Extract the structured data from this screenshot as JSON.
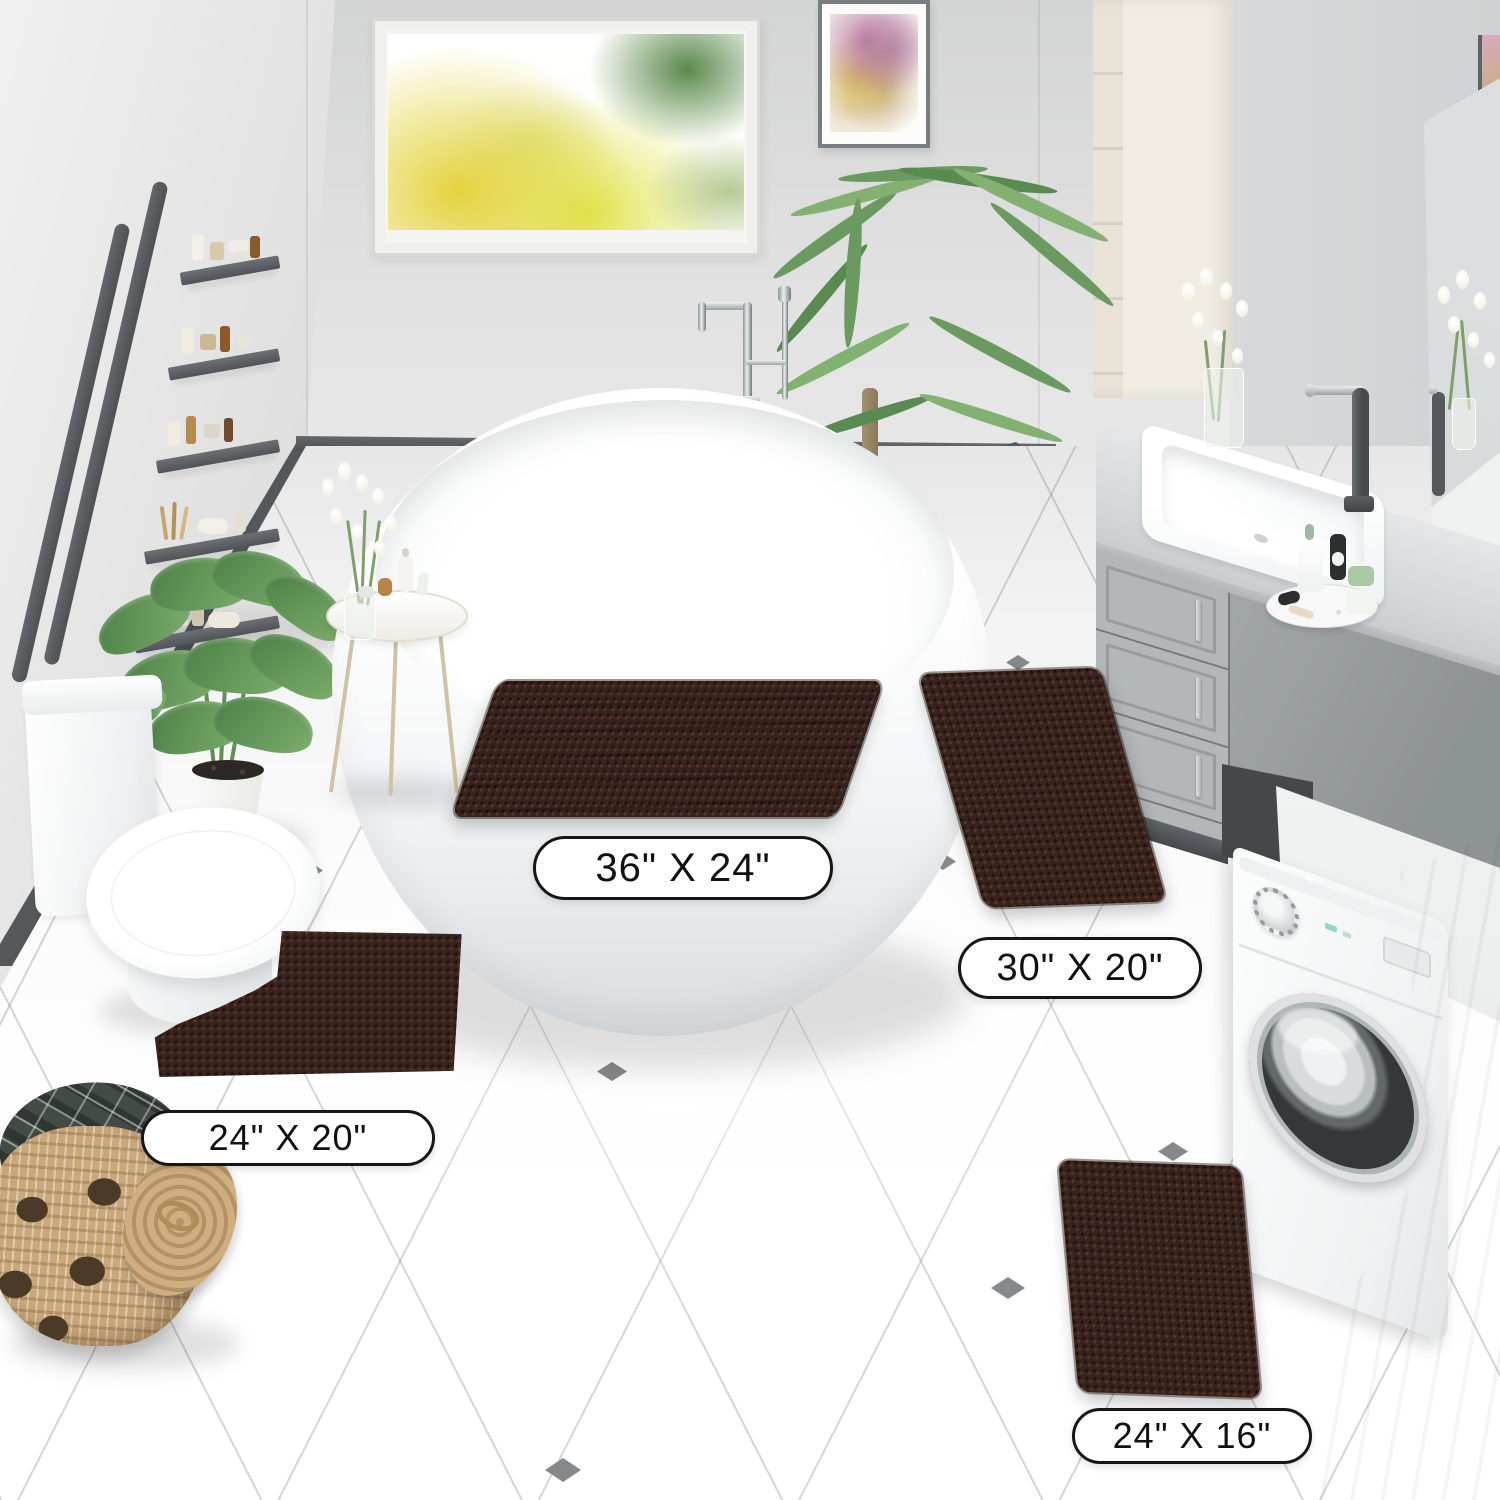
{
  "page": {
    "type": "product-photo",
    "scene": "modern bathroom showcasing a 4-piece brown chenille bath rug set"
  },
  "size_labels": [
    {
      "rug": "rectangular-large",
      "text": "36\" X 24\""
    },
    {
      "rug": "rectangular-medium",
      "text": "30\" X 20\""
    },
    {
      "rug": "contour-u-shape",
      "text": "24\" X 20\""
    },
    {
      "rug": "rectangular-small",
      "text": "24\" X 16\""
    }
  ],
  "palette": {
    "rug_brown": "#38221c",
    "wall_gray": "#dcdddd",
    "floor_white": "#f9f9f9",
    "cabinet_gray": "#a0a5a8",
    "dark_gray_accent": "#54585b",
    "basket_tan": "#c9a87c",
    "plant_green": "#6b9a60",
    "label_background": "#ffffff",
    "label_border": "#161616",
    "label_text": "#111111"
  },
  "objects": [
    "window with autumn trees",
    "framed watercolor wall art",
    "ladder shelf with toiletries",
    "potted green plant",
    "toilet",
    "freestanding oval bathtub",
    "floor-mounted chrome tub faucet",
    "palm plant",
    "round side table with cosmetics",
    "vase with white flowers",
    "gray vanity with white sink and dark faucet",
    "wall mirror",
    "tall cream cabinet",
    "front-load washing machine",
    "white laundry counter",
    "wicker basket with plaid towel",
    "brown chenille bath rug 36x24",
    "brown chenille bath rug 30x20",
    "brown chenille contour rug 24x20",
    "brown chenille bath rug 24x16"
  ]
}
